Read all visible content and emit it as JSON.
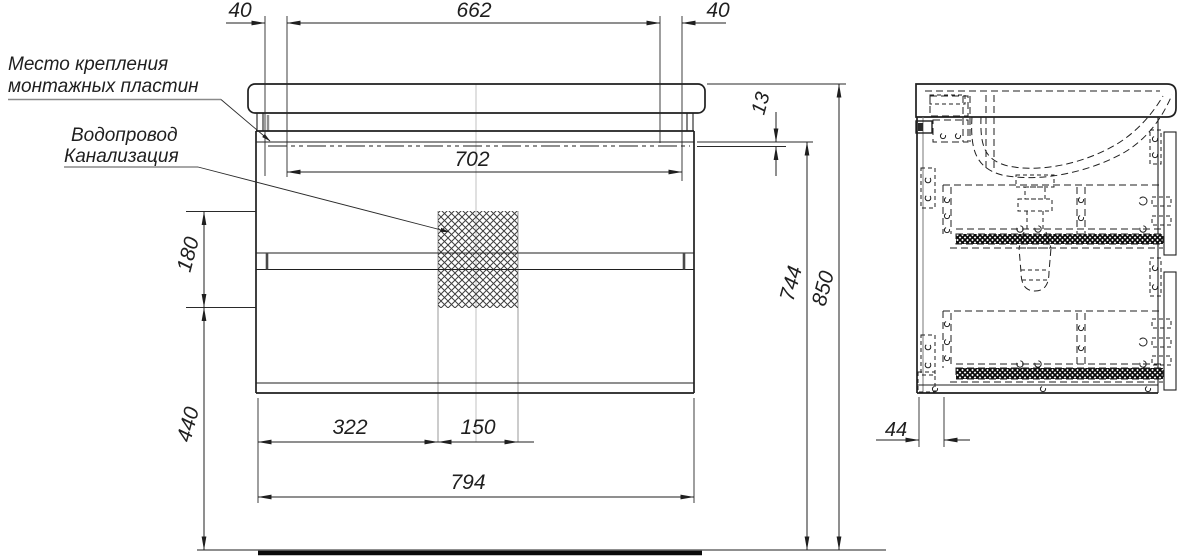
{
  "drawing": {
    "type": "furniture technical drawing, wall-hung washbasin vanity cabinet, front and side views",
    "labels": {
      "mounting_plates_line1": "Место крепления",
      "mounting_plates_line2": "монтажных пластин",
      "water_supply": "Водопровод",
      "sewerage": "Канализация"
    },
    "dims": {
      "plate_offset_left": "40",
      "plate_spacing": "662",
      "plate_offset_right": "40",
      "rail_length": "702",
      "rail_drop": "13",
      "service_zone_height": "180",
      "floor_to_cabinet": "440",
      "service_zone_offset": "322",
      "service_zone_width": "150",
      "cabinet_width": "794",
      "rail_height": "744",
      "total_height": "850",
      "back_inset": "44"
    },
    "colors": {
      "line": "#1f1f1f",
      "auxiliary": "#9a9a9a",
      "background": "#ffffff"
    }
  }
}
